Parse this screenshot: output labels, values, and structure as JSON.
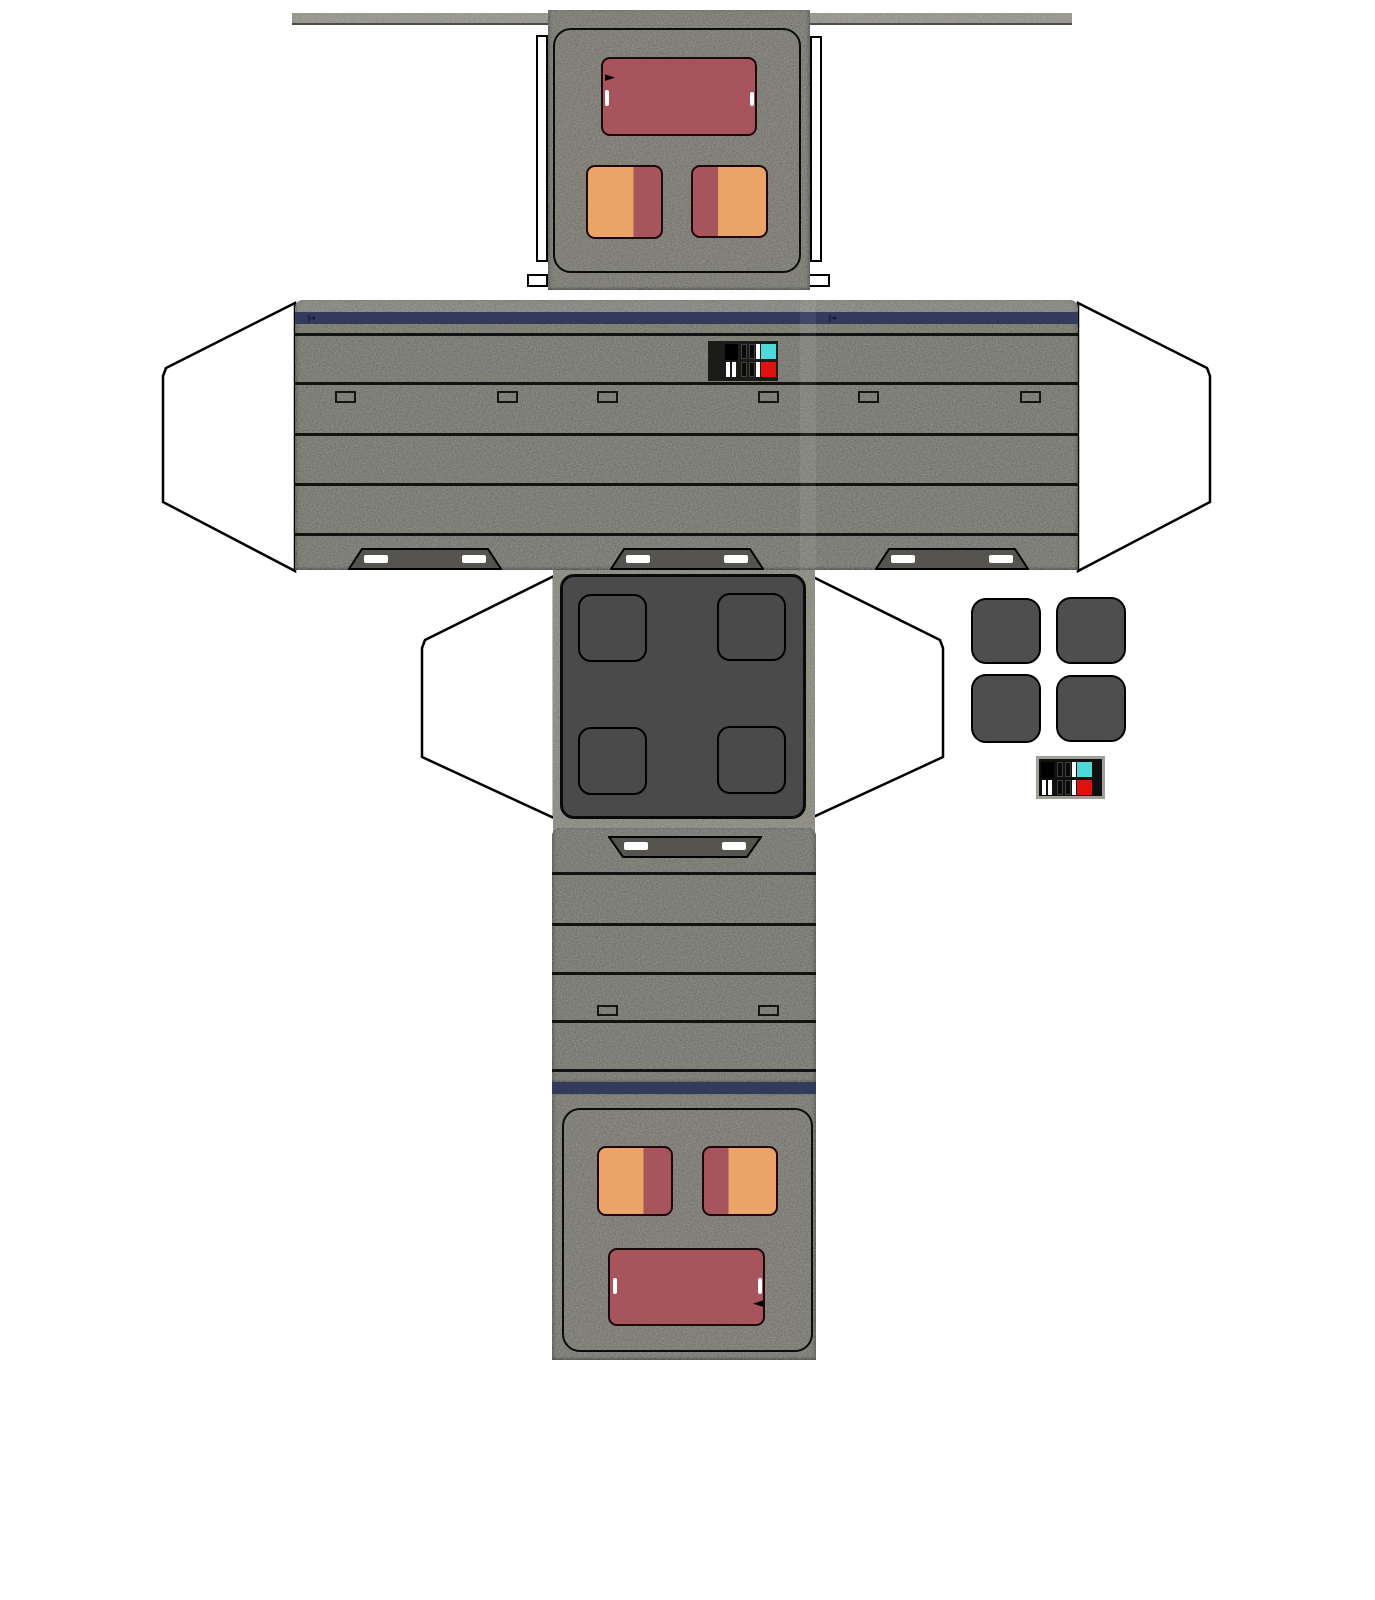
{
  "sheet": {
    "kind": "papercraft cut-out template",
    "subject": "grey sci-fi box droid fold-up model with glue flaps",
    "background": "#ffffff"
  },
  "colors": {
    "bar_gray": "#85857d",
    "panel_gray": "#67675f",
    "band_gray": "#64645d",
    "strip_gray": "#79796f",
    "dark_square": "#4a4a4a",
    "pad_gray": "#4e4e4e",
    "skid_gray": "#55544e",
    "navy": "#333a5c",
    "maroon": "#a7545c",
    "orange": "#eba367",
    "cyan": "#4fd8d8",
    "red": "#e2100f",
    "frame_gray": "#a0a098",
    "outline": "#000000",
    "white": "#ffffff"
  },
  "glyphs": {
    "stripe_mark": "‖◄",
    "arrow_right": "►",
    "arrow_left": "◄"
  },
  "features": {
    "band_vents": 6,
    "band_skids": 3,
    "back_vents": 2,
    "back_skids": 1,
    "foot_pad_cutouts": 4,
    "spare_foot_pads": 4,
    "control_decals": 2,
    "glue_flaps": 4,
    "glue_tabs": 4
  }
}
